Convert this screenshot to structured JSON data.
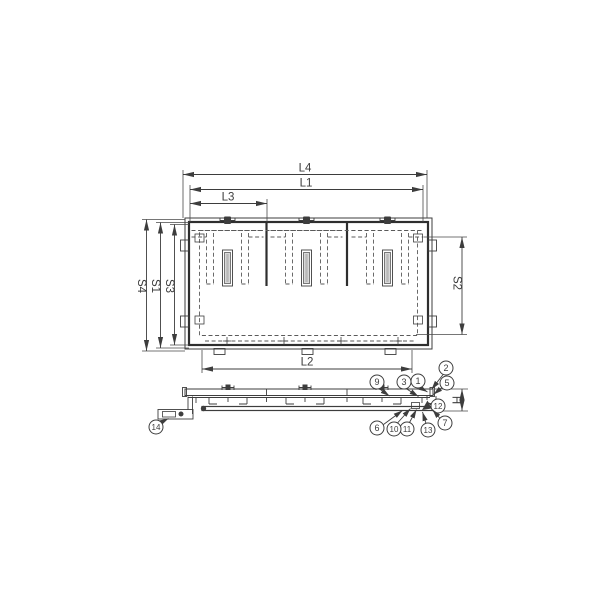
{
  "drawing": {
    "description": "technical drawing with plan view and side section view",
    "plan_dimensions_top": [
      "L4",
      "L1",
      "L3"
    ],
    "plan_dimensions_left": [
      "S4",
      "S1",
      "S3"
    ],
    "plan_dimensions_right": [
      "S2"
    ],
    "plan_dimensions_bottom": [
      "L2"
    ],
    "section_dimension": [
      "H"
    ],
    "balloon_numbers": [
      "1",
      "2",
      "3",
      "5",
      "6",
      "7",
      "9",
      "10",
      "11",
      "12",
      "13",
      "14"
    ]
  },
  "labels": {
    "L4": "L4",
    "L1": "L1",
    "L3": "L3",
    "L2": "L2",
    "S4": "S4",
    "S1": "S1",
    "S3": "S3",
    "S2": "S2",
    "H": "H"
  },
  "balloons": {
    "b1": "1",
    "b2": "2",
    "b3": "3",
    "b5": "5",
    "b6": "6",
    "b7": "7",
    "b9": "9",
    "b10": "10",
    "b11": "11",
    "b12": "12",
    "b13": "13",
    "b14": "14"
  },
  "colors": {
    "line": "#3d3d3d",
    "slot_fill": "#d9d9d9",
    "background": "#ffffff"
  }
}
